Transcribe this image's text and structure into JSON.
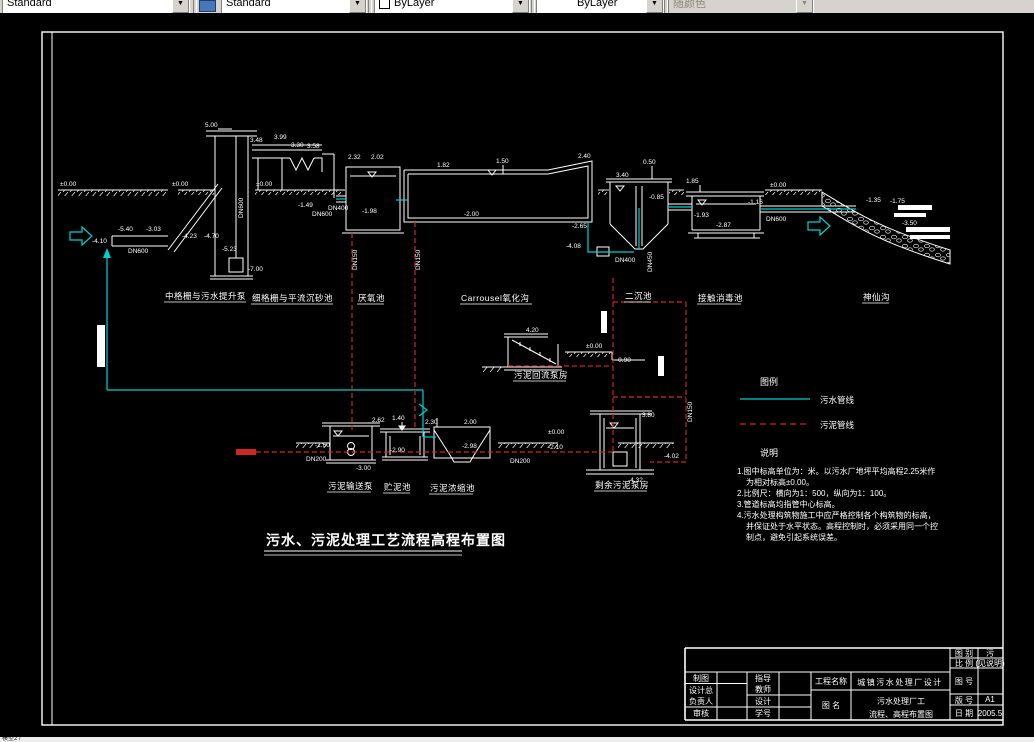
{
  "toolbar": {
    "combos": [
      {
        "value": "Standard"
      },
      {
        "value": "Standard"
      },
      {
        "value": "ByLayer"
      },
      {
        "value": "ByLayer"
      },
      {
        "value": "随颜色"
      }
    ],
    "icons": {
      "dropdown_arrow": "▼"
    }
  },
  "statusbar": {
    "text": "模型2 /"
  },
  "colors": {
    "sewage_line": "#00d0d0",
    "sludge_line": "#cc2626",
    "canvas": "#000000",
    "toolbar_bg": "#d6d3ce",
    "frame": "#ffffff"
  },
  "drawing": {
    "main_title": "污水、污泥处理工艺流程高程布置图",
    "flow_labels": [
      "中格栅与污水提升泵",
      "细格栅与平流沉砂池",
      "厌氧池",
      "Carrousel氧化沟",
      "二沉池",
      "接触消毒池",
      "神仙沟",
      "污泥回流泵房",
      "污泥输送泵",
      "贮泥池",
      "污泥浓缩池",
      "剩余污泥泵房"
    ],
    "elevations": [
      "5.00",
      "±0.00",
      "±0.00",
      "±0.00",
      "3.48",
      "3.99",
      "3.30",
      "3.58",
      "-5.40",
      "-3.03",
      "-4.10",
      "-4.23",
      "-4.70",
      "DN600",
      "-5.23",
      "-7.00",
      "-1.49",
      "DN600",
      "2.32",
      "2.02",
      "DN400",
      "-1.98",
      "1.82",
      "1.50",
      "2.40",
      "-2.00",
      "-2.65",
      "-4.08",
      "3.40",
      "0.50",
      "-0.85",
      "DN400",
      "DN450",
      "DN150",
      "DN150",
      "1.85",
      "±0.00",
      "-1.16",
      "DN600",
      "-1.35",
      "-1.75",
      "-3.50",
      "-1.93",
      "-2.87",
      "4.20",
      "±0.00",
      "-0.90",
      "2.62",
      "1.40",
      "2.30",
      "2.00",
      "±0.00",
      "-2.10",
      "-1.60",
      "-3.00",
      "-2.98",
      "DN200",
      "DN200",
      "3.80",
      "-4.02",
      "-4.32",
      "DN150",
      "DN600",
      "-2.90"
    ],
    "legend": {
      "title": "图例",
      "sewage": "污水管线",
      "sludge": "污泥管线"
    },
    "notes": {
      "title": "说明",
      "lines": [
        "1.图中标高单位为：米。以污水厂地坪平均高程2.25米作",
        "为相对标高±0.00。",
        "2.比例尺：横向为1：500，纵向为1：100。",
        "3.管道标高均指管中心标高。",
        "4.污水处理构筑物施工中应严格控制各个构筑物的标高，",
        "并保证处于水平状态。高程控制时，必须采用同一个控",
        "制点，避免引起系统误差。"
      ]
    }
  },
  "title_block": {
    "draw_label": "制图",
    "chief1": "设计总",
    "chief2": "负责人",
    "review_label": "审核",
    "advisor1": "指导",
    "advisor2": "教师",
    "design_label": "设计",
    "studentid_label": "学号",
    "project_label": "工程名称",
    "project_value": "城镇污水处理厂设计",
    "drawing_name_label": "图 名",
    "drawing_name_line1": "污水处理厂工",
    "drawing_name_line2": "流程、高程布置图",
    "category_label": "图 别",
    "category_value": "污",
    "scale_label": "比 例",
    "scale_value": "(见说明)",
    "number_label": "图 号",
    "version_label": "版 号",
    "version_value": "A1",
    "date_label": "日 期",
    "date_value": "2005.5"
  }
}
